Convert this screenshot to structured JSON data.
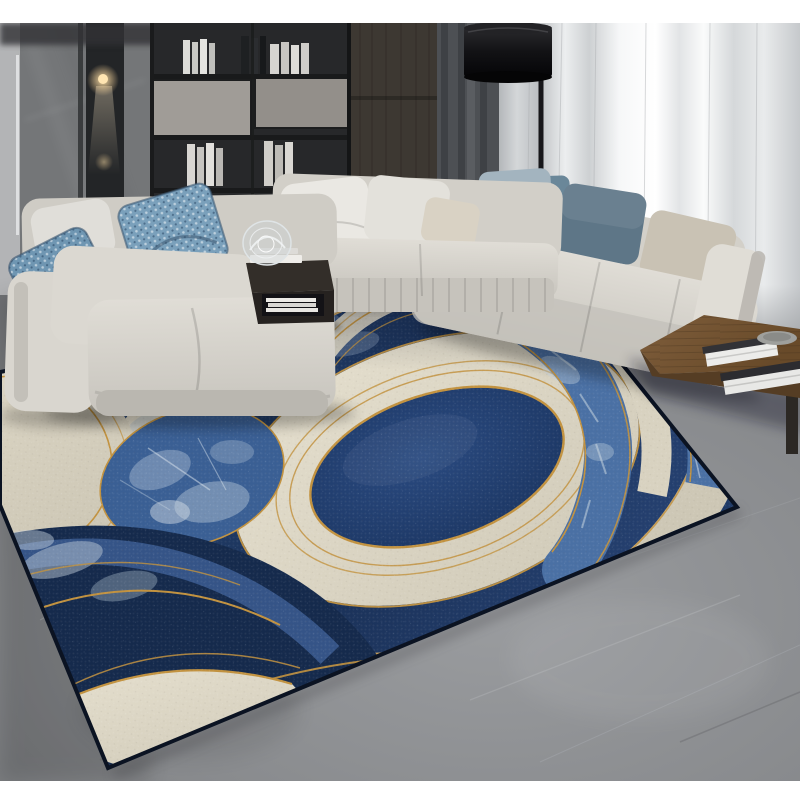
{
  "scene": {
    "description": "Modern living room photo: gray sectional sofas with blue patterned pillows, marble wall with dark shelving and books, sheer white curtains, black floor lamp, dark side table with glass decor, wooden coffee table with books, and a large navy-blue and cream abstract circle-pattern area rug with gold accent lines on a gray marble floor, letterboxed by white bars top and bottom."
  },
  "palette": {
    "navy": "#1f3a66",
    "navy_deep": "#152a4c",
    "navy_ring": "#223f70",
    "steel_blue": "#4a70a4",
    "ice": "#bccbda",
    "cream": "#d8d2c0",
    "cream_bright": "#e6e1d1",
    "gold": "#c2923f",
    "floor": "#8b8d90",
    "floor_dark": "#626467",
    "wall": "#77797b",
    "wall_dark": "#2b2d2f",
    "wood_panel": "#46403a",
    "curtain_sheer": "#e7e9eb",
    "curtain_dark": "#4d5054",
    "sofa": "#d7d4cd",
    "sofa_shadow": "#b5b2ab",
    "pillow_blue": "#7aa0bb",
    "pillow_slate": "#5e7687",
    "pillow_greige": "#c9c2b4",
    "table_wood": "#7a5a38",
    "table_wood_dark": "#553d24",
    "furniture_dark": "#332e29",
    "lamp": "#121214",
    "glow": "#ffd79a",
    "border_white": "#ffffff"
  }
}
